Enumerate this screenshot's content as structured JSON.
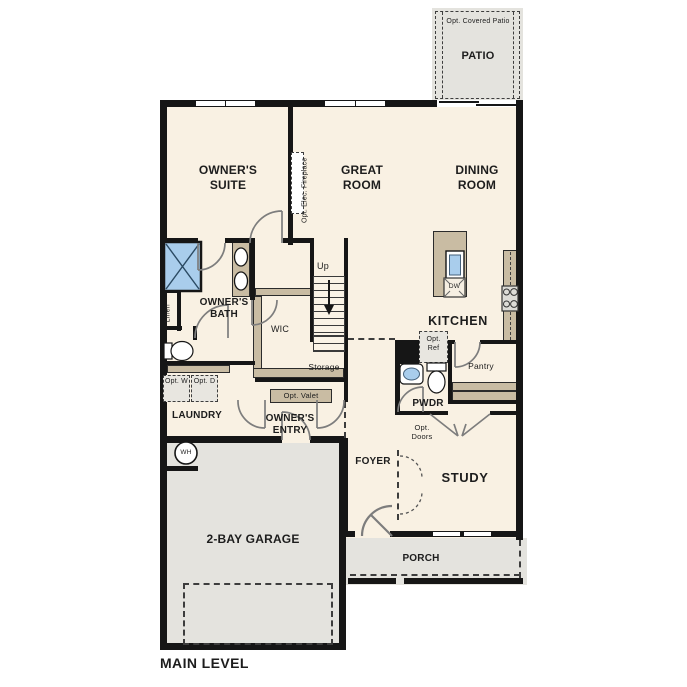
{
  "title": "MAIN LEVEL",
  "colors": {
    "floor": "#f9f1e3",
    "exterior_surface": "#e4e3de",
    "wall": "#161616",
    "cabinet": "#c9bca3",
    "fixture_blue": "#a9cdec"
  },
  "labels": {
    "patio": "PATIO",
    "opt_covered_patio": "Opt. Covered Patio",
    "owners_suite": "OWNER'S SUITE",
    "great_room": "GREAT ROOM",
    "opt_elec_fireplace": "Opt. Elec. Fireplace",
    "dining_room": "DINING ROOM",
    "kitchen": "KITCHEN",
    "dw": "DW",
    "opt_ref": "Opt. Ref",
    "pantry": "Pantry",
    "owners_bath": "OWNER'S BATH",
    "linen": "Linen",
    "wic": "WIC",
    "up": "Up",
    "storage": "Storage",
    "opt_valet": "Opt. Valet",
    "laundry": "LAUNDRY",
    "opt_w": "Opt. W",
    "opt_d": "Opt. D",
    "owners_entry": "OWNER'S ENTRY",
    "wh": "WH",
    "garage": "2-BAY GARAGE",
    "foyer": "FOYER",
    "pwdr": "PWDR",
    "opt_doors": "Opt. Doors",
    "study": "STUDY",
    "porch": "PORCH",
    "main_level": "MAIN LEVEL"
  }
}
